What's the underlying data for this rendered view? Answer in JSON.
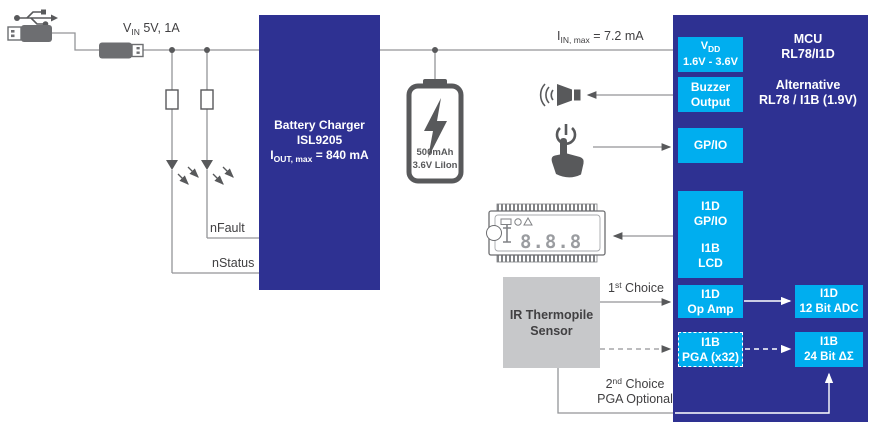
{
  "colors": {
    "navy": "#2e3192",
    "cyan": "#00aeef",
    "sensor_gray": "#c7c8ca",
    "icon_gray": "#58595b",
    "wire_gray": "#939598",
    "label_text": "#414042"
  },
  "labels": {
    "vin": {
      "sym": "V",
      "sub": "IN",
      "rest": " 5V, 1A"
    },
    "iin": {
      "sym": "I",
      "sub": "IN, max",
      "rest": " = 7.2 mA"
    },
    "nfault": "nFault",
    "nstatus": "nStatus",
    "choice1": {
      "num": "1",
      "sup": "st",
      "rest": " Choice"
    },
    "choice2": {
      "num": "2",
      "sup": "nd",
      "rest": " Choice",
      "line2": "PGA Optional"
    }
  },
  "charger": {
    "line1": "Battery Charger",
    "line2": "ISL9205",
    "iout": {
      "sym": "I",
      "sub": "OUT, max",
      "rest": " = 840 mA"
    }
  },
  "battery": {
    "line1": "500mAh",
    "line2": "3.6V LiIon"
  },
  "sensor": {
    "line1": "IR Thermopile",
    "line2": "Sensor"
  },
  "mcu": {
    "title": "MCU",
    "part": "RL78/I1D",
    "alt1": "Alternative",
    "alt2": "RL78 / I1B (1.9V)",
    "vdd": {
      "sym": "V",
      "sub": "DD",
      "line2": "1.6V - 3.6V"
    },
    "buzzer": {
      "line1": "Buzzer",
      "line2": "Output"
    },
    "gpio": "GP/IO",
    "io_lcd": {
      "l1": "I1D",
      "l2": "GP/IO",
      "l3": "I1B",
      "l4": "LCD"
    },
    "opamp": {
      "line1": "I1D",
      "line2": "Op Amp"
    },
    "pga": {
      "line1": "I1B",
      "line2": "PGA (x32)"
    },
    "adc": {
      "line1": "I1D",
      "line2": "12 Bit ADC"
    },
    "dsm": {
      "line1": "I1B",
      "line2": "24 Bit ΔΣ"
    }
  },
  "lcd_icon": {
    "digits": "8.8.8"
  }
}
